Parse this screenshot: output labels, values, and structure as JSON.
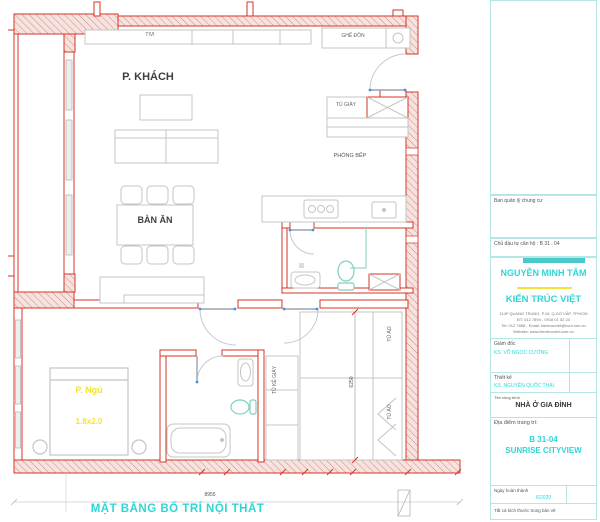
{
  "drawing_title": "MẶT BẰNG BỐ TRÍ NỘI THẤT",
  "plan": {
    "labels": {
      "tv": "TIVI",
      "living_room": "P. KHÁCH",
      "dining_table": "BÀN ĂN",
      "stool": "GHẾ ĐÔN",
      "shoe_cabinet": "TỦ GIÀY",
      "kitchen": "PHÒNG BẾP",
      "bedroom": "P. Ngủ",
      "bed_size": "1.8x2.0",
      "shoe_shelf": "TỦ KỆ GIÀY",
      "wardrobe_top": "TỦ ÁO",
      "wardrobe_bottom": "TỦ ÁO"
    },
    "dimensions": {
      "overall_width": "8955",
      "side": "6250"
    }
  },
  "title_block": {
    "management_label": "Ban quản lý chung cư",
    "investor_label": "Chủ đầu tư căn hộ : B 31 . 04",
    "client_name": "NGUYỄN MINH TÂM",
    "company_name": "KIẾN TRÚC VIỆT",
    "address_lines": [
      "114F QUANG TRUNG, P.10, Q.GÒ VẤP, TP.HCM",
      "ĐT: 012 7894 - 0918 01 02 24",
      "Tel: 012 7898 - Email: kientrucviet@hcm.vnn.vn",
      "Website: www.kientrucviet.com.vn"
    ],
    "director_label": "Giám đốc",
    "director_name": "KS. VÕ NGỌC CƯỜNG",
    "designer_label": "Thiết kế",
    "designer_name": "KS. NGUYỄN QUỐC THÁI",
    "project_label": "Tên công trình",
    "project_name": "NHÀ Ở GIA ĐÌNH",
    "location_label": "Địa điểm trang trí:",
    "location_line1": "B 31-04",
    "location_line2": "SUNRISE CITYVIEW",
    "date_label": "Ngày hoàn thành",
    "date_value": "6/2020",
    "note": "Tất cả kích thước trong bản vẽ"
  },
  "colors": {
    "wall_red": "#d63427",
    "accent_cyan": "#2fd6d6",
    "label_yellow": "#f2e23a",
    "fixture_teal": "#7fcfc4",
    "furniture_gray": "#c4c4c4"
  }
}
